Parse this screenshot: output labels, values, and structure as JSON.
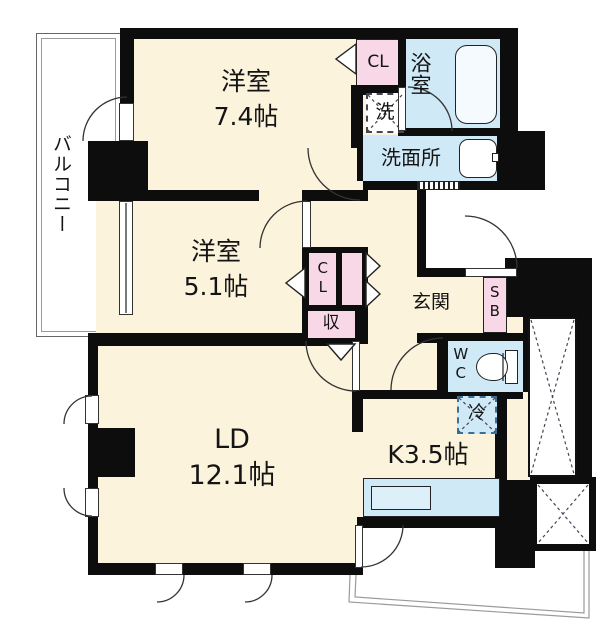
{
  "floorplan": {
    "balcony": "バルコニー",
    "bedroom1": {
      "name": "洋室",
      "size": "7.4帖"
    },
    "bedroom2": {
      "name": "洋室",
      "size": "5.1帖"
    },
    "living": {
      "name": "LD",
      "size": "12.1帖"
    },
    "kitchen": {
      "name": "K3.5帖"
    },
    "bath": "浴室",
    "washroom": "洗面所",
    "laundry": "洗",
    "toilet": "WC",
    "entrance": "玄関",
    "shoebox": "SB",
    "closet_top": "CL",
    "closet_mid": "CL",
    "storage": "収",
    "fridge": "冷",
    "colors": {
      "room_fill": "#fcf3dc",
      "wet_area_fill": "#cfe9f7",
      "closet_fill": "#f8d8e6",
      "wall": "#0d0d0d",
      "outline": "#9a9a9a"
    }
  }
}
